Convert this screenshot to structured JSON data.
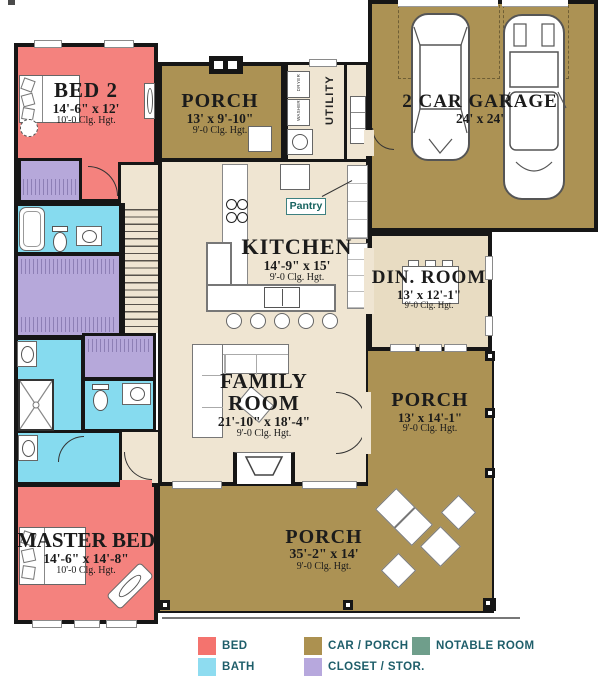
{
  "colors": {
    "bed": "#F4827E",
    "bath": "#86DBEF",
    "closet": "#B6A8DA",
    "car_porch": "#AC9254",
    "notable": "#6F9E8B",
    "floor": "#EFE5D2",
    "dining_floor": "#E8DCC2",
    "wall": "#161616",
    "legend_text": "#1E5E6A"
  },
  "rooms": {
    "bed2": {
      "name": "BED 2",
      "dims": "14'-6\" x 12'",
      "clg": "10'-0 Clg. Hgt."
    },
    "porch_top": {
      "name": "PORCH",
      "dims": "13' x 9'-10\"",
      "clg": "9'-0 Clg. Hgt."
    },
    "utility": {
      "name": "UTILITY"
    },
    "garage": {
      "name": "2 CAR GARAGE",
      "dims": "24' x 24'"
    },
    "kitchen": {
      "name": "KITCHEN",
      "dims": "14'-9\" x 15'",
      "clg": "9'-0 Clg. Hgt."
    },
    "pantry": {
      "name": "Pantry"
    },
    "dining": {
      "name": "DIN. ROOM",
      "dims": "13' x 12'-1\"",
      "clg": "9'-0 Clg. Hgt."
    },
    "family": {
      "name": "FAMILY ROOM",
      "dims": "21'-10\" x 18'-4\"",
      "clg": "9'-0 Clg. Hgt."
    },
    "porch_right": {
      "name": "PORCH",
      "dims": "13' x 14'-1\"",
      "clg": "9'-0 Clg. Hgt."
    },
    "master": {
      "name": "MASTER BED",
      "dims": "14'-6\" x 14'-8\"",
      "clg": "10'-0 Clg. Hgt."
    },
    "porch_bottom": {
      "name": "PORCH",
      "dims": "35'-2\" x 14'",
      "clg": "9'-0 Clg. Hgt."
    }
  },
  "appliances": {
    "dryer": "DRYER",
    "washer": "WASHER"
  },
  "legend": {
    "items": [
      {
        "label": "BED",
        "color": "#F4736E"
      },
      {
        "label": "BATH",
        "color": "#8EDCF0"
      },
      {
        "label": "CAR / PORCH",
        "color": "#AC9150"
      },
      {
        "label": "CLOSET / STOR.",
        "color": "#B7A8DD"
      },
      {
        "label": "NOTABLE ROOM",
        "color": "#6F9E8B"
      }
    ]
  }
}
